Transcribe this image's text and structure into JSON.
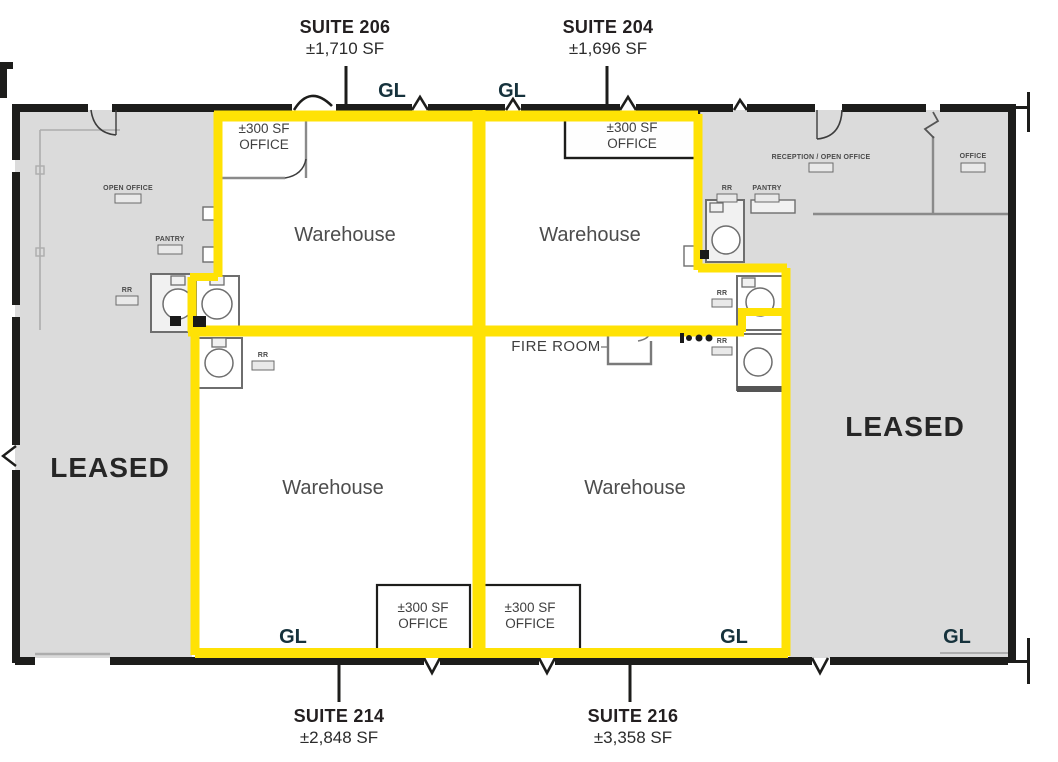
{
  "colors": {
    "suite_outline": "#FFE205",
    "leased_fill": "#DBDBDB",
    "wall": "#1D1D1B",
    "gl_text": "#16323C",
    "suite_text": "#231F20",
    "room_text": "#4D4D4D",
    "leased_text": "#262626"
  },
  "suites": {
    "s206": {
      "name": "SUITE 206",
      "area": "±1,710 SF"
    },
    "s204": {
      "name": "SUITE 204",
      "area": "±1,696 SF"
    },
    "s214": {
      "name": "SUITE 214",
      "area": "±2,848 SF"
    },
    "s216": {
      "name": "SUITE 216",
      "area": "±3,358 SF"
    }
  },
  "labels": {
    "gl": "GL",
    "leased": "LEASED",
    "warehouse": "Warehouse",
    "fire_room": "FIRE ROOM",
    "office_sf": "±300 SF",
    "office_word": "OFFICE"
  },
  "annotations": {
    "open_office": "OPEN OFFICE",
    "pantry": "PANTRY",
    "rr": "RR",
    "reception_open_office": "RECEPTION / OPEN OFFICE",
    "office": "OFFICE"
  }
}
